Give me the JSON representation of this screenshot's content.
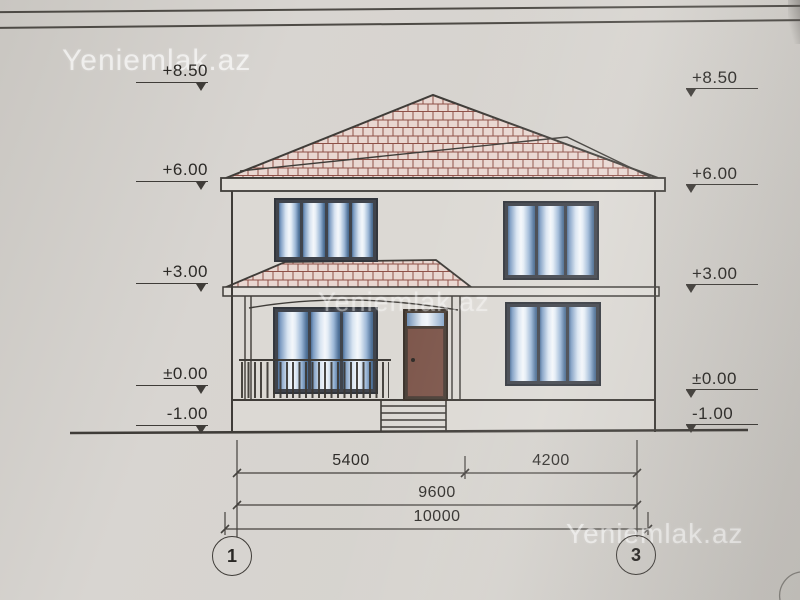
{
  "watermark": {
    "text": "Yeniemlak.az"
  },
  "elevations": {
    "left": [
      {
        "label": "+8.50"
      },
      {
        "label": "+6.00"
      },
      {
        "label": "+3.00"
      },
      {
        "label": "±0.00"
      },
      {
        "label": "-1.00"
      }
    ],
    "right": [
      {
        "label": "+8.50"
      },
      {
        "label": "+6.00"
      },
      {
        "label": "+3.00"
      },
      {
        "label": "±0.00"
      },
      {
        "label": "-1.00"
      }
    ]
  },
  "dimensions": {
    "row1": [
      {
        "label": "5400"
      },
      {
        "label": "4200"
      }
    ],
    "row2": [
      {
        "label": "9600"
      }
    ],
    "row3": [
      {
        "label": "10000"
      }
    ]
  },
  "axis_markers": [
    {
      "label": "1"
    },
    {
      "label": "3"
    }
  ],
  "colors": {
    "paper": "#d2cfca",
    "ink": "#3f3c38",
    "roof-fill": "#e9d7d1",
    "roof-line": "#8e5047",
    "frame": "#40444c",
    "door": "#7d564b",
    "wall": "#dcd9d4",
    "band": "#e1ded9"
  }
}
